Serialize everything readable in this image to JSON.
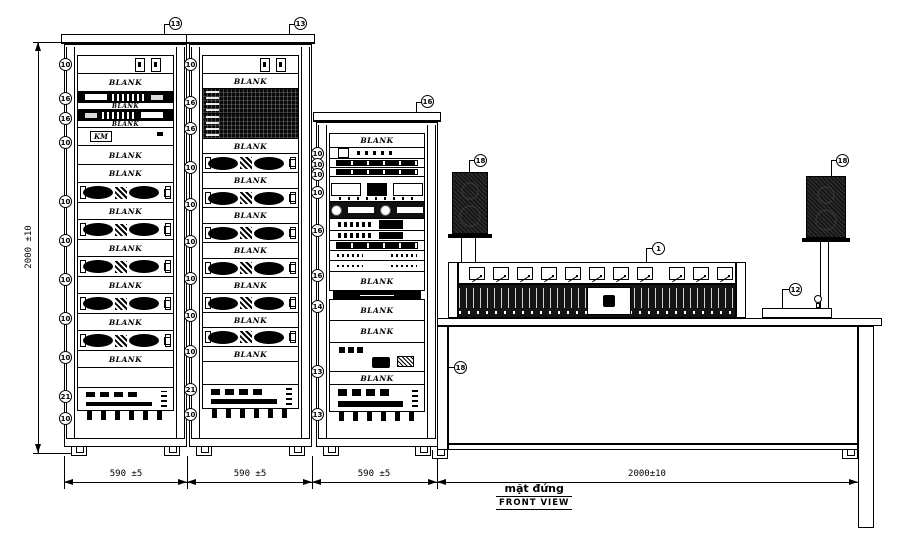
{
  "drawing": {
    "title_local": "mặt đứng",
    "title_en": "FRONT VIEW"
  },
  "dimensions": {
    "height_label": "2000 ±10",
    "rack1_width": "590 ±5",
    "rack2_width": "590 ±5",
    "rack3_width": "590 ±5",
    "table_width": "2000±10"
  },
  "callouts": {
    "rack1_top": "13",
    "rack2_top": "13",
    "rack3_top": "16",
    "speaker_left": "18",
    "speaker_right": "18",
    "console": "1",
    "mic_stand": "12",
    "table": "18"
  },
  "blank_label": "BLANK",
  "racks": [
    {
      "id": "1",
      "x": 64,
      "top": 34,
      "w": 123,
      "callout": "13",
      "units": [
        {
          "t": "io",
          "h": 19,
          "c": "10"
        },
        {
          "t": "blank",
          "h": 19,
          "l": "BLANK"
        },
        {
          "t": "dev-dark",
          "h": 12,
          "c": "16"
        },
        {
          "t": "blank-thin",
          "h": 8,
          "l": "BLANK"
        },
        {
          "t": "dev-dark2",
          "h": 12,
          "c": "16"
        },
        {
          "t": "blank-thin",
          "h": 8,
          "l": "BLANK"
        },
        {
          "t": "logo",
          "h": 19,
          "c": "10",
          "l": "KM"
        },
        {
          "t": "blank",
          "h": 20,
          "l": "BLANK"
        },
        {
          "t": "blank",
          "h": 19,
          "l": "BLANK"
        },
        {
          "t": "amp",
          "h": 21,
          "c": "10"
        },
        {
          "t": "blank",
          "h": 18,
          "l": "BLANK"
        },
        {
          "t": "amp",
          "h": 21,
          "c": "10"
        },
        {
          "t": "blank",
          "h": 18,
          "l": "BLANK"
        },
        {
          "t": "amp",
          "h": 21,
          "c": "10"
        },
        {
          "t": "blank",
          "h": 18,
          "l": "BLANK"
        },
        {
          "t": "amp",
          "h": 21,
          "c": "10"
        },
        {
          "t": "blank",
          "h": 18,
          "l": "BLANK"
        },
        {
          "t": "amp",
          "h": 21,
          "c": "10"
        },
        {
          "t": "blank",
          "h": 18,
          "l": "BLANK"
        },
        {
          "t": "empty",
          "h": 21,
          "c": "21"
        },
        {
          "t": "power",
          "h": 24,
          "c": "10"
        },
        {
          "t": "vent",
          "h": 10
        }
      ]
    },
    {
      "id": "2",
      "x": 189,
      "top": 34,
      "w": 123,
      "callout": "13",
      "units": [
        {
          "t": "io",
          "h": 19,
          "c": "10"
        },
        {
          "t": "blank",
          "h": 16,
          "l": "BLANK"
        },
        {
          "t": "perf",
          "h": 26,
          "c": "16"
        },
        {
          "t": "perf",
          "h": 26,
          "c": "16"
        },
        {
          "t": "blank",
          "h": 16,
          "l": "BLANK"
        },
        {
          "t": "amp",
          "h": 20,
          "c": "10"
        },
        {
          "t": "blank",
          "h": 17,
          "l": "BLANK"
        },
        {
          "t": "amp",
          "h": 20,
          "c": "10"
        },
        {
          "t": "blank",
          "h": 17,
          "l": "BLANK"
        },
        {
          "t": "amp",
          "h": 20,
          "c": "10"
        },
        {
          "t": "blank",
          "h": 17,
          "l": "BLANK"
        },
        {
          "t": "amp",
          "h": 20,
          "c": "10"
        },
        {
          "t": "blank",
          "h": 17,
          "l": "BLANK"
        },
        {
          "t": "amp",
          "h": 20,
          "c": "10"
        },
        {
          "t": "blank",
          "h": 16,
          "l": "BLANK"
        },
        {
          "t": "amp",
          "h": 20,
          "c": "10"
        },
        {
          "t": "blank",
          "h": 16,
          "l": "BLANK"
        },
        {
          "t": "empty",
          "h": 24,
          "c": "21"
        },
        {
          "t": "power",
          "h": 25,
          "c": "10"
        },
        {
          "t": "vent",
          "h": 10
        }
      ]
    },
    {
      "id": "3",
      "x": 316,
      "top": 112,
      "w": 122,
      "callout": "16",
      "units": [
        {
          "t": "blank",
          "h": 15,
          "l": "BLANK"
        },
        {
          "t": "devsq",
          "h": 12,
          "c": "10"
        },
        {
          "t": "devthin",
          "h": 10,
          "c": "10"
        },
        {
          "t": "devthin",
          "h": 10,
          "c": "10"
        },
        {
          "t": "deck",
          "h": 26,
          "c": "10"
        },
        {
          "t": "cd",
          "h": 18
        },
        {
          "t": "devbtn",
          "h": 13,
          "c": "16"
        },
        {
          "t": "devbtn",
          "h": 11
        },
        {
          "t": "devthin",
          "h": 11
        },
        {
          "t": "devscatter",
          "h": 11
        },
        {
          "t": "devscatter",
          "h": 12,
          "c": "16"
        },
        {
          "t": "blank",
          "h": 20,
          "l": "BLANK"
        },
        {
          "t": "ventstrip",
          "h": 10,
          "c": "14"
        },
        {
          "t": "blank",
          "h": 22,
          "l": "BLANK"
        },
        {
          "t": "blank",
          "h": 23,
          "l": "BLANK"
        },
        {
          "t": "dev2u",
          "h": 30,
          "c": "13"
        },
        {
          "t": "blank",
          "h": 14,
          "l": "BLANK"
        },
        {
          "t": "power",
          "h": 28,
          "c": "13"
        },
        {
          "t": "vent",
          "h": 10
        }
      ]
    }
  ],
  "console": {
    "meter_count_left": 8,
    "meter_count_right": 3
  }
}
